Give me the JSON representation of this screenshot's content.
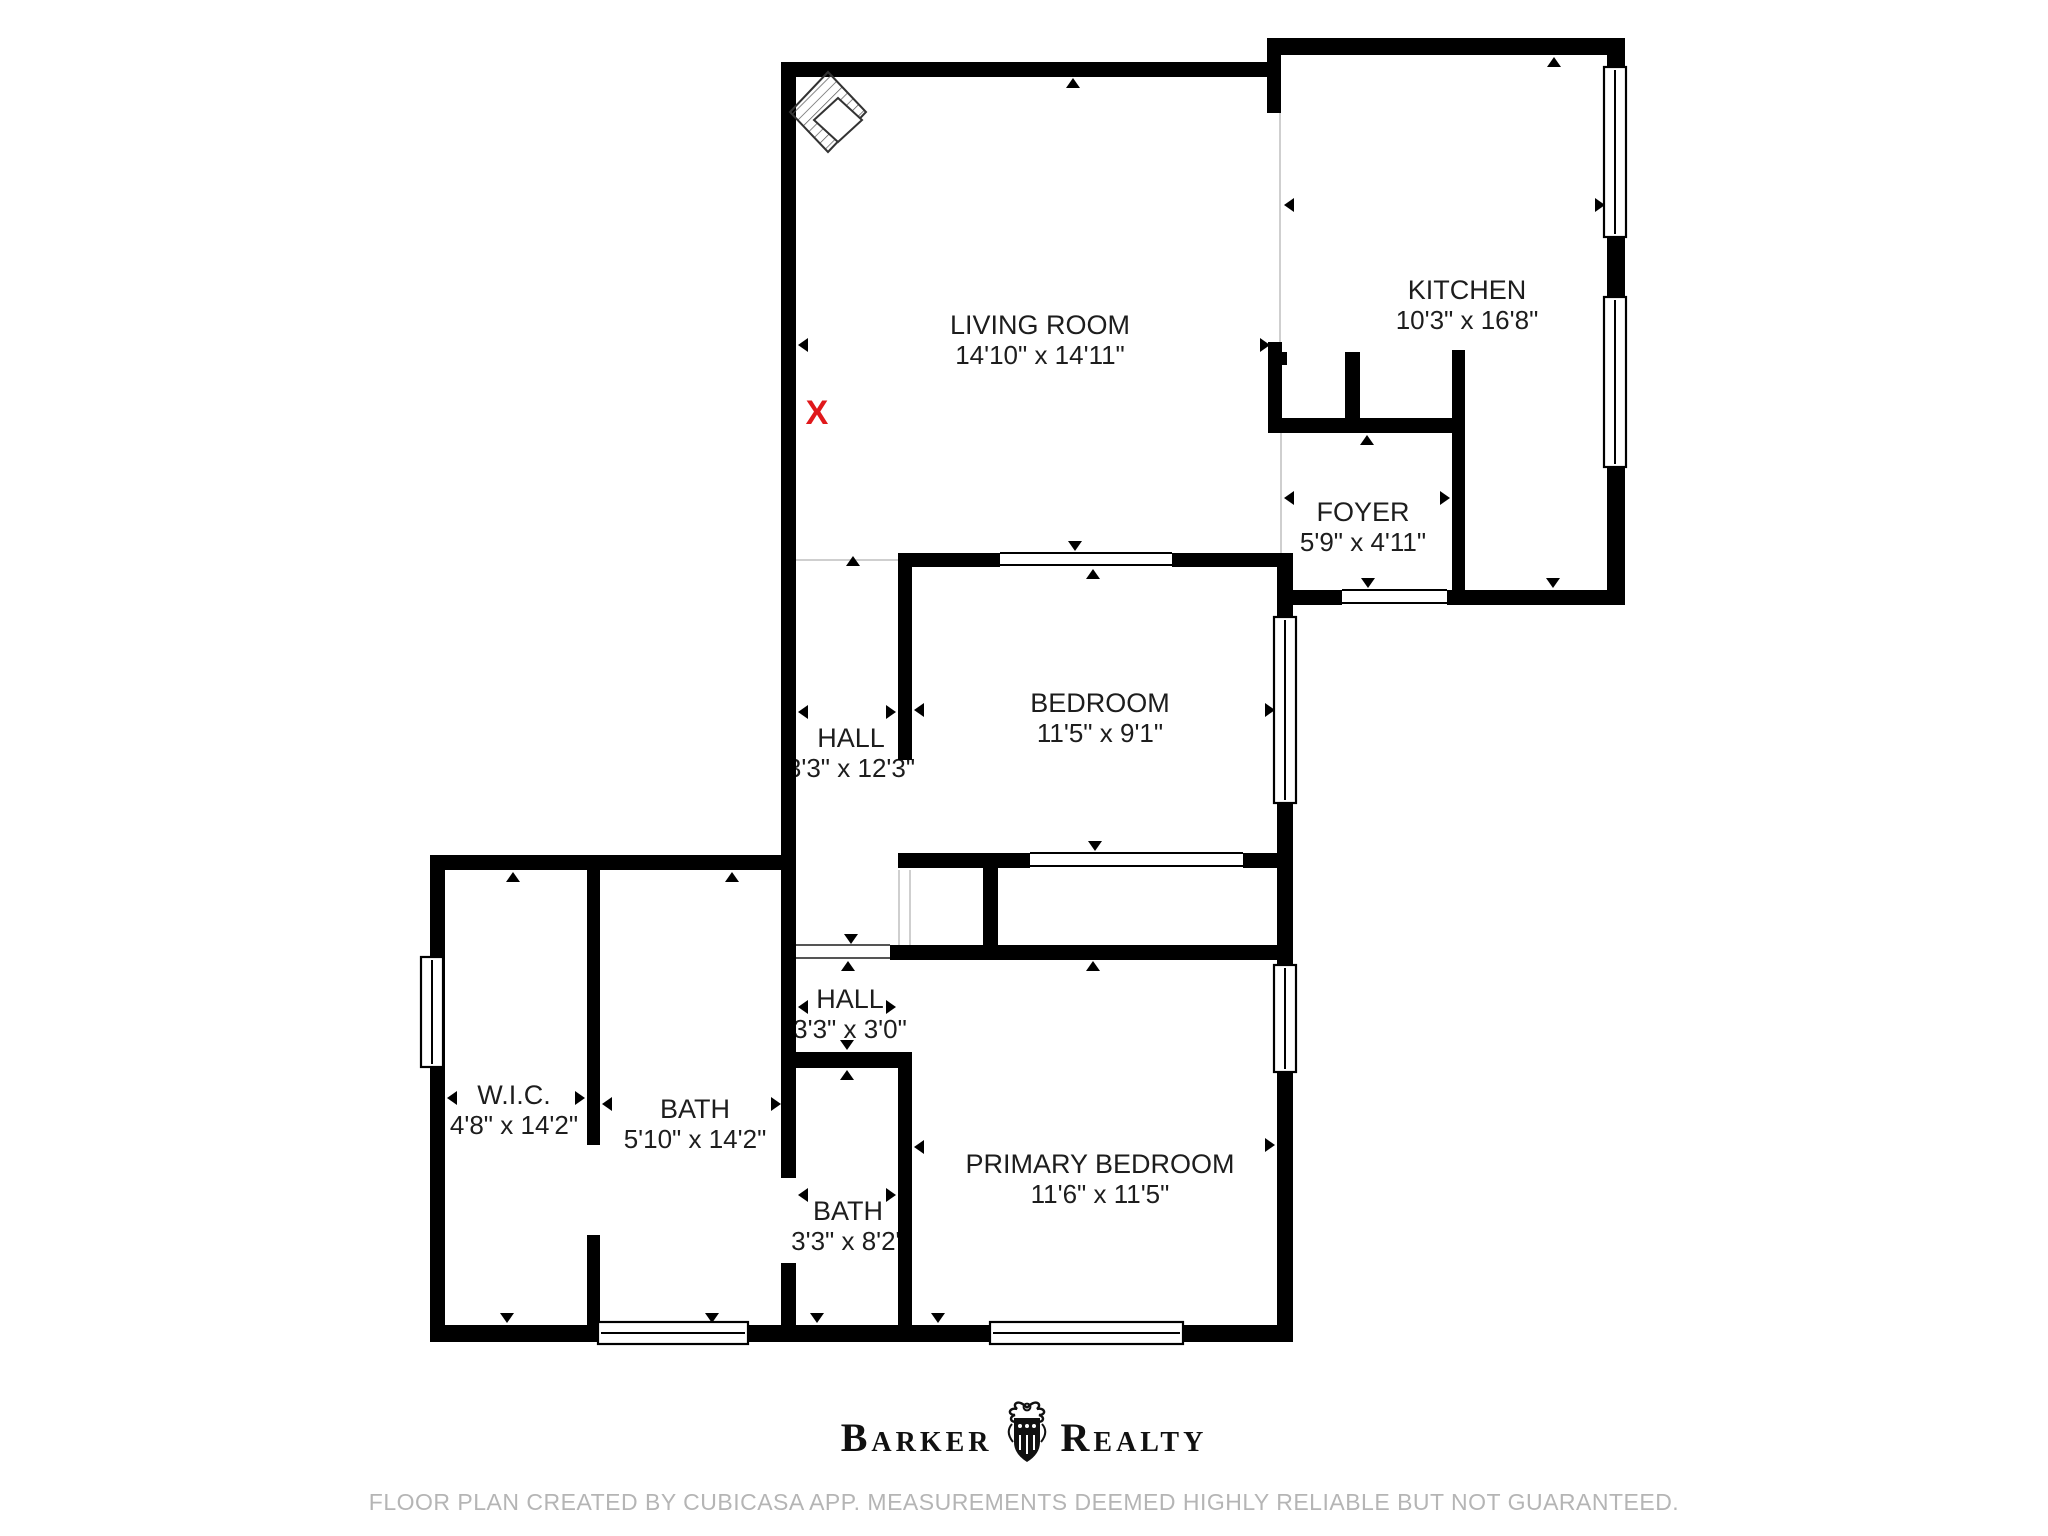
{
  "rooms": {
    "living_room": {
      "name": "LIVING ROOM",
      "dims": "14'10\" x 14'11\""
    },
    "kitchen": {
      "name": "KITCHEN",
      "dims": "10'3\" x 16'8\""
    },
    "foyer": {
      "name": "FOYER",
      "dims": "5'9\" x 4'11\""
    },
    "bedroom": {
      "name": "BEDROOM",
      "dims": "11'5\" x 9'1\""
    },
    "hall_upper": {
      "name": "HALL",
      "dims": "3'3\" x 12'3\""
    },
    "hall_lower": {
      "name": "HALL",
      "dims": "3'3\" x 3'0\""
    },
    "wic": {
      "name": "W.I.C.",
      "dims": "4'8\" x 14'2\""
    },
    "bath_large": {
      "name": "BATH",
      "dims": "5'10\" x 14'2\""
    },
    "bath_small": {
      "name": "BATH",
      "dims": "3'3\" x 8'2\""
    },
    "primary_bedroom": {
      "name": "PRIMARY BEDROOM",
      "dims": "11'6\" x 11'5\""
    }
  },
  "marker": {
    "label": "X",
    "color": "#e0181b"
  },
  "footer": {
    "brand_left": "Barker",
    "brand_right": "Realty",
    "disclaimer": "FLOOR PLAN CREATED BY CUBICASA APP. MEASUREMENTS DEEMED HIGHLY RELIABLE BUT NOT GUARANTEED."
  },
  "colors": {
    "wall": "#000000",
    "label": "#1d1d1d",
    "disclaimer": "#b5b5b5"
  }
}
